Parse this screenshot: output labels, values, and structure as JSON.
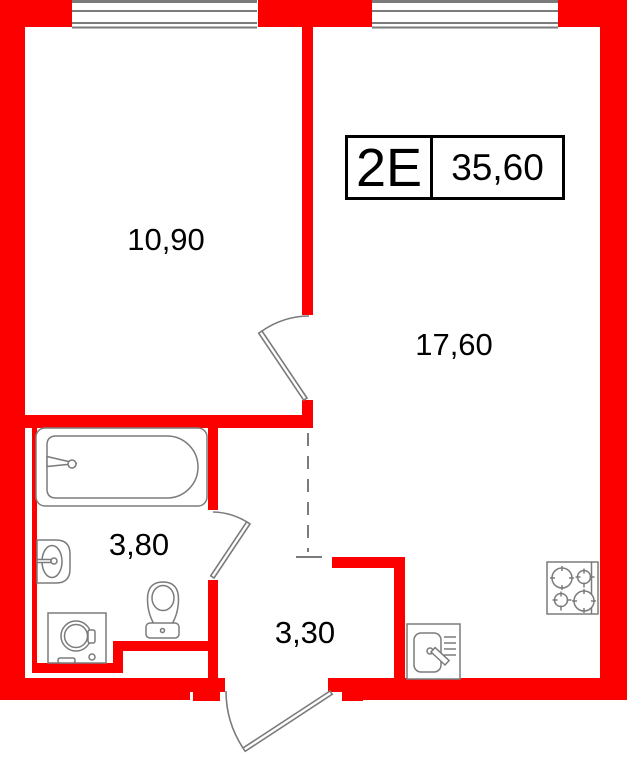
{
  "unit": {
    "type": "2E",
    "total_area": "35,60"
  },
  "areas": {
    "bedroom": "10,90",
    "living_room": "17,60",
    "bathroom": "3,80",
    "hallway": "3,30"
  },
  "colors": {
    "wall": "#fc0000",
    "line": "#7b7b7b",
    "text": "#000000"
  },
  "fixtures": [
    "window",
    "door",
    "bathtub",
    "washbasin",
    "toilet",
    "washing-machine",
    "kitchen-sink",
    "stove"
  ]
}
